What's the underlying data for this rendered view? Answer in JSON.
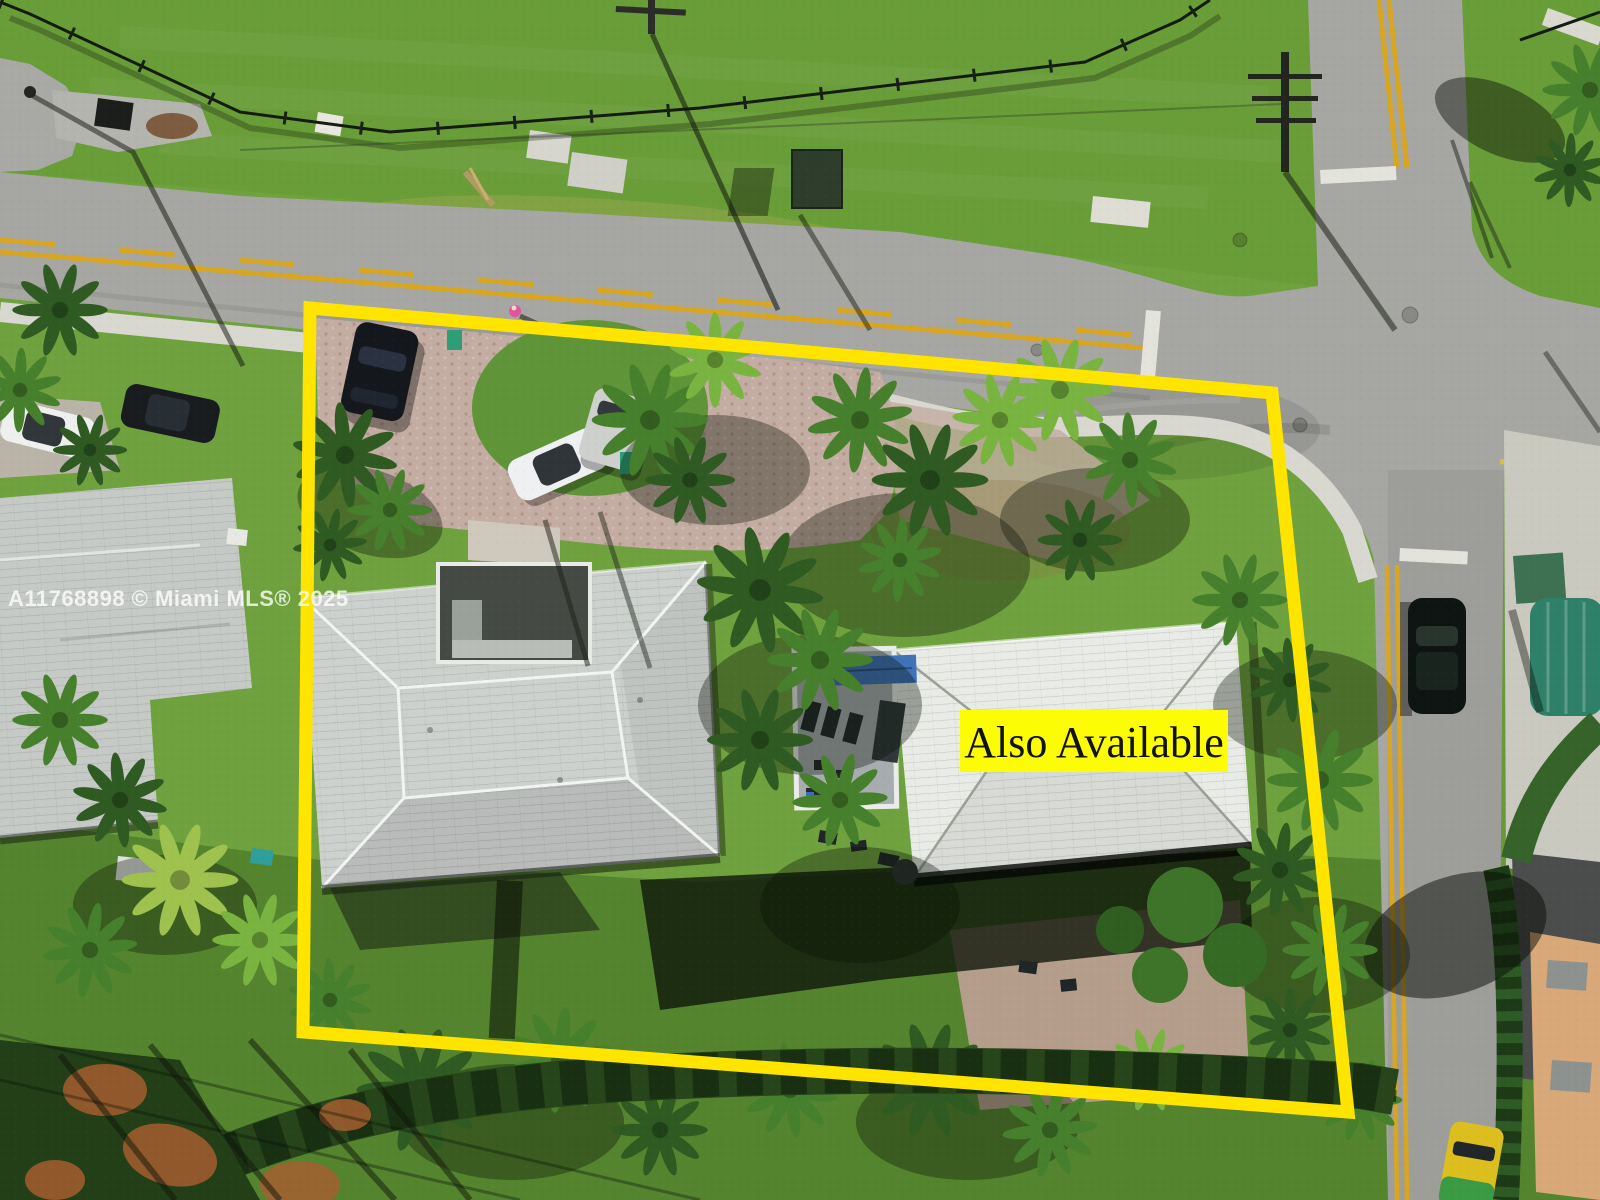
{
  "overlay": {
    "watermark": "A11768898 © Miami MLS® 2025",
    "label": "Also Available"
  },
  "palette": {
    "boundary_yellow": "#FFE400",
    "label_bg": "#FCFC05",
    "label_text": "#121212",
    "watermark_color": "rgba(255,255,255,0.78)",
    "grass_light": "#6FA23F",
    "grass_field": "#699D38",
    "grass_dark": "#55842F",
    "road_gray": "#A6A6A2",
    "roof_left": "#CDD1CE",
    "roof_right": "#E9EBE7",
    "paver_tan": "#C3ACA1",
    "center_line_yellow": "#D9A622",
    "palm_dark": "#2F5A22",
    "palm_mid": "#47802C",
    "palm_bright": "#79B441",
    "palm_yellow": "#9FC24F",
    "awning_green": "#2F8068",
    "pool_blue": "#3F72B8",
    "taxi_yellow": "#DDBE1F",
    "hedge_green": "#27451B",
    "mulch_orange": "#A55E2F"
  }
}
